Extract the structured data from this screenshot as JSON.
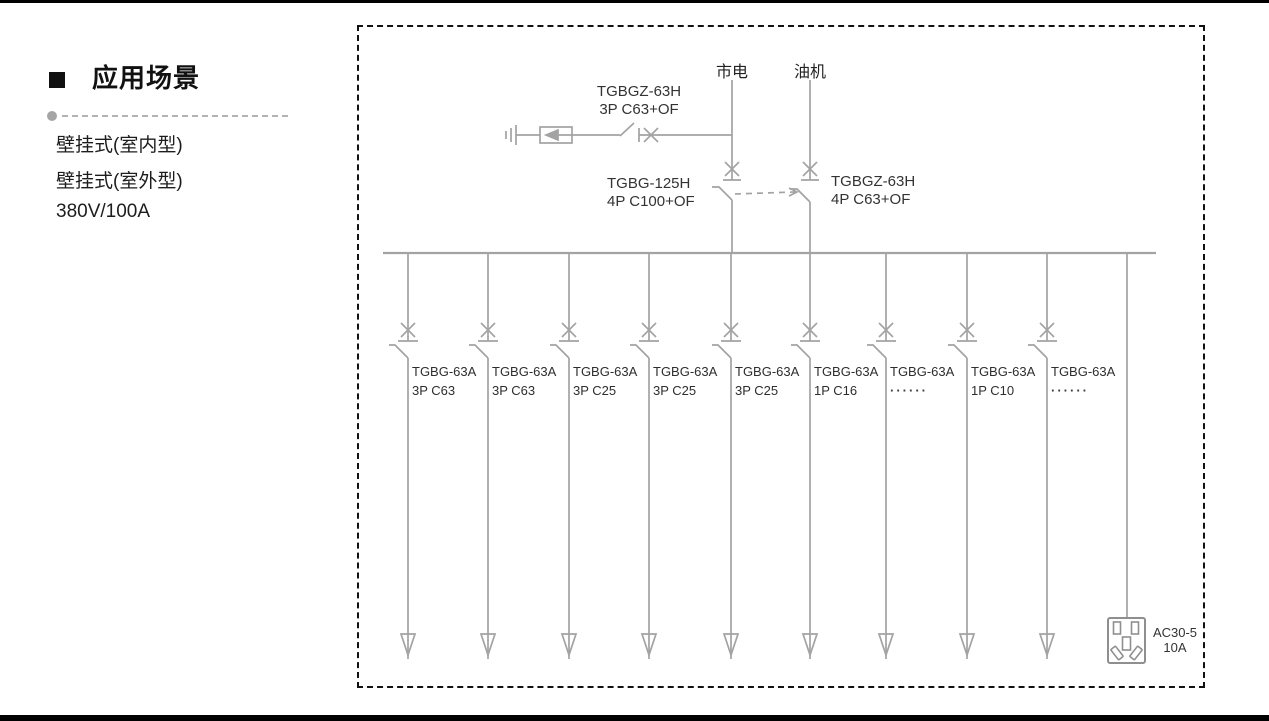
{
  "sidebar": {
    "title": "应用场景",
    "items": [
      "壁挂式(室内型)",
      "壁挂式(室外型)",
      "380V/100A"
    ]
  },
  "diagram": {
    "sources": {
      "mains": "市电",
      "generator": "油机"
    },
    "spd_breaker": {
      "line1": "TGBGZ-63H",
      "line2": "3P C63+OF"
    },
    "main_breaker": {
      "line1": "TGBG-125H",
      "line2": "4P C100+OF"
    },
    "gen_breaker": {
      "line1": "TGBGZ-63H",
      "line2": "4P C63+OF"
    },
    "branches": [
      {
        "model": "TGBG-63A",
        "spec": "3P C63"
      },
      {
        "model": "TGBG-63A",
        "spec": "3P C63"
      },
      {
        "model": "TGBG-63A",
        "spec": "3P C25"
      },
      {
        "model": "TGBG-63A",
        "spec": "3P C25"
      },
      {
        "model": "TGBG-63A",
        "spec": "3P C25"
      },
      {
        "model": "TGBG-63A",
        "spec": "1P C16"
      },
      {
        "model": "TGBG-63A",
        "spec": "······"
      },
      {
        "model": "TGBG-63A",
        "spec": "1P C10"
      },
      {
        "model": "TGBG-63A",
        "spec": "······"
      }
    ],
    "socket": {
      "line1": "AC30-5",
      "line2": "10A"
    }
  },
  "colors": {
    "diagram_line": "#a3a3a3",
    "diagram_text": "#333333",
    "border": "#111111",
    "page_rule": "#000000"
  }
}
